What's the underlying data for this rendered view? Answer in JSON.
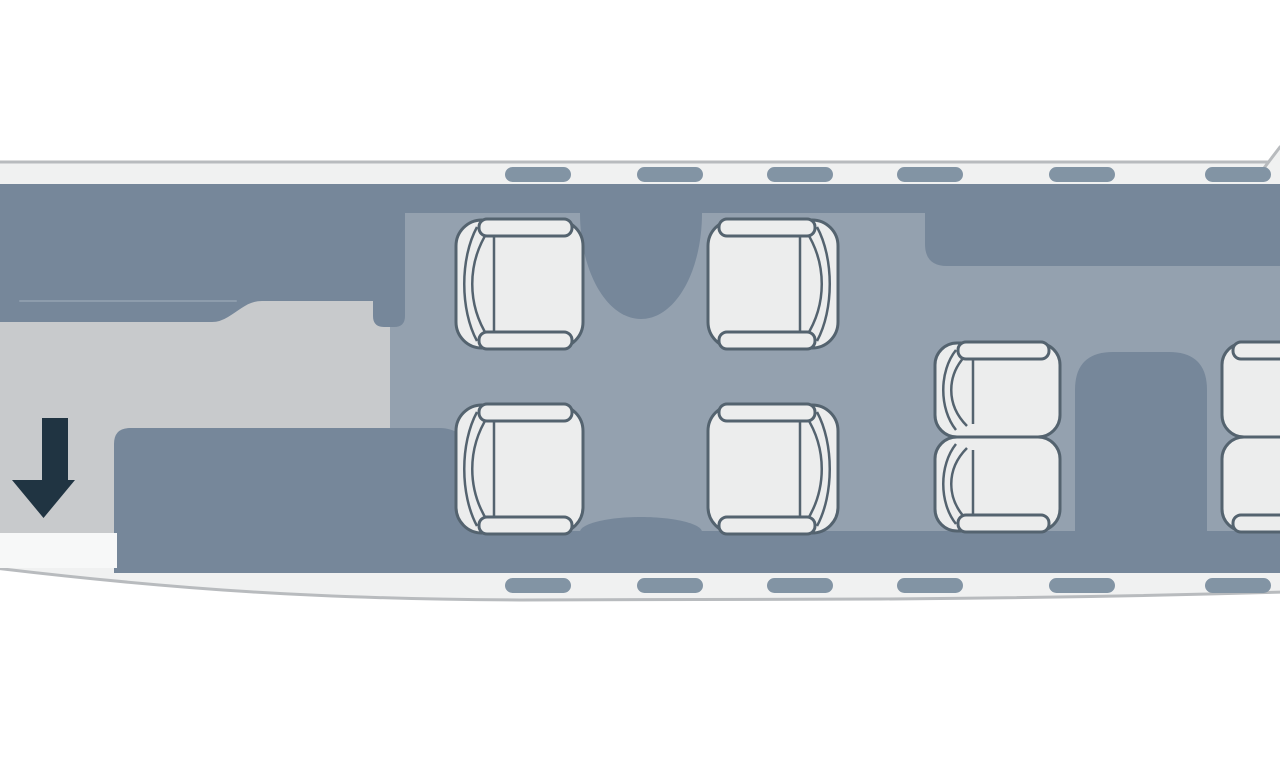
{
  "diagram": {
    "kind": "aircraft-cabin-floor-plan-top-view",
    "canvas": {
      "width": 1280,
      "height": 768
    },
    "colors": {
      "page_background": "#ffffff",
      "fuselage_fill": "#F0F1F1",
      "fuselage_stroke": "#B8BBBE",
      "sidewall_dark": "#76879A",
      "cabin_floor": "#94A1AF",
      "vestibule_floor": "#C8CACC",
      "seat_fill": "#ECEDED",
      "seat_stroke": "#54636F",
      "window": "#8294A4",
      "entry_arrow": "#203442",
      "door": "#F7F8F8",
      "galley_seam": "#8D9CAC"
    },
    "shapes": [
      {
        "name": "fuselage-outline",
        "d": "M-5,162 L1285,162 L1285,592 C1180,595 1040,598 880,599 L520,600 C320,599 180,590 -5,568 Z",
        "fill": "fuselage_fill",
        "stroke": "fuselage_stroke",
        "sw": 3
      },
      {
        "name": "wing-root-fill",
        "d": "M1261,172 L1280,147 L1285,147 L1285,172 Z",
        "fill": "fuselage_fill"
      },
      {
        "name": "wing-root-edge",
        "d": "M1261,172 L1280,147",
        "stroke": "fuselage_stroke",
        "sw": 3
      },
      {
        "name": "vestibule-floor",
        "d": "M-5,184 L392,184 L392,568 L-5,568 Z",
        "fill": "vestibule_floor"
      },
      {
        "name": "cabin-floor",
        "d": "M390,184 L1285,184 L1285,573 L390,573 Z",
        "fill": "cabin_floor"
      },
      {
        "name": "sidewall-top-band",
        "d": "M-5,184 L1285,184 L1285,213 L-5,213 Z",
        "fill": "sidewall_dark"
      },
      {
        "name": "aft-galley-top",
        "d": "M925,184 L1285,184 L1285,266 L947,266 Q925,266 925,244 Z",
        "fill": "sidewall_dark"
      },
      {
        "name": "forward-galley",
        "d": "M-5,184 L405,184 L405,316 Q405,327 394,327 L384,327 Q373,327 373,316 L373,301 L262,301 C248,301 240,310 228,317 Q220,322 212,322 L-5,322 Z",
        "fill": "sidewall_dark"
      },
      {
        "name": "forward-table",
        "d": "M580,206 L702,206 L702,213 C702,272 675,319 641,319 C607,319 580,272 580,213 Z",
        "fill": "sidewall_dark"
      },
      {
        "name": "table-base-bump",
        "d": "M580,547 L580,532 C580,524 607,517 641,517 C675,517 702,524 702,532 L702,547 Z",
        "fill": "sidewall_dark"
      },
      {
        "name": "aft-lower-sidewall",
        "d": "M130,428 L440,428 C472,428 492,470 512,531 L1285,531 L1285,573 L114,573 L114,444 Q114,428 130,428 Z",
        "fill": "sidewall_dark"
      },
      {
        "name": "aft-cabinet",
        "d": "M1075,390 Q1075,352 1113,352 L1169,352 Q1207,352 1207,390 L1207,540 L1075,540 Z",
        "fill": "sidewall_dark"
      },
      {
        "name": "galley-seam",
        "d": "M20,301 L236,301",
        "stroke": "galley_seam",
        "sw": 2
      },
      {
        "name": "entry-door",
        "d": "M-5,533 L117,533 L117,568 L-5,568 Z",
        "fill": "door"
      },
      {
        "name": "entry-arrow",
        "d": "M42,418 L68,418 L68,480 L75,480 L43.5,518 L12,480 L42,480 Z",
        "fill": "entry_arrow"
      }
    ],
    "windows": {
      "w": 66,
      "h": 15,
      "r": 7.5,
      "top_y": 167,
      "bottom_y": 578,
      "columns": [
        505,
        637,
        767,
        897,
        1049,
        1205
      ],
      "fill": "window"
    },
    "seats": [
      {
        "id": "club-forward-left",
        "x": 456,
        "y": 220,
        "w": 127,
        "h": 128,
        "facing": "right",
        "armrests": [
          "top",
          "bottom"
        ]
      },
      {
        "id": "club-rear-left",
        "x": 456,
        "y": 405,
        "w": 127,
        "h": 128,
        "facing": "right",
        "armrests": [
          "top",
          "bottom"
        ]
      },
      {
        "id": "club-forward-right",
        "x": 708,
        "y": 220,
        "w": 130,
        "h": 128,
        "facing": "left",
        "armrests": [
          "top",
          "bottom"
        ]
      },
      {
        "id": "club-rear-right",
        "x": 708,
        "y": 405,
        "w": 130,
        "h": 128,
        "facing": "left",
        "armrests": [
          "top",
          "bottom"
        ]
      },
      {
        "id": "aft-pair-left-1",
        "x": 935,
        "y": 343,
        "w": 125,
        "h": 94,
        "facing": "right",
        "armrests": [
          "top"
        ]
      },
      {
        "id": "aft-pair-left-2",
        "x": 935,
        "y": 437,
        "w": 125,
        "h": 94,
        "facing": "right",
        "armrests": [
          "bottom"
        ]
      },
      {
        "id": "aft-pair-right-1",
        "x": 1222,
        "y": 343,
        "w": 133,
        "h": 94,
        "facing": "left",
        "armrests": [
          "top"
        ]
      },
      {
        "id": "aft-pair-right-2",
        "x": 1222,
        "y": 437,
        "w": 133,
        "h": 94,
        "facing": "left",
        "armrests": [
          "bottom"
        ]
      }
    ],
    "seat_style": {
      "rx_large": 26,
      "rx_small": 22,
      "body_sw": 3,
      "arc_sw": 2.5,
      "armrest_h": 17,
      "seam_x": 38
    }
  }
}
